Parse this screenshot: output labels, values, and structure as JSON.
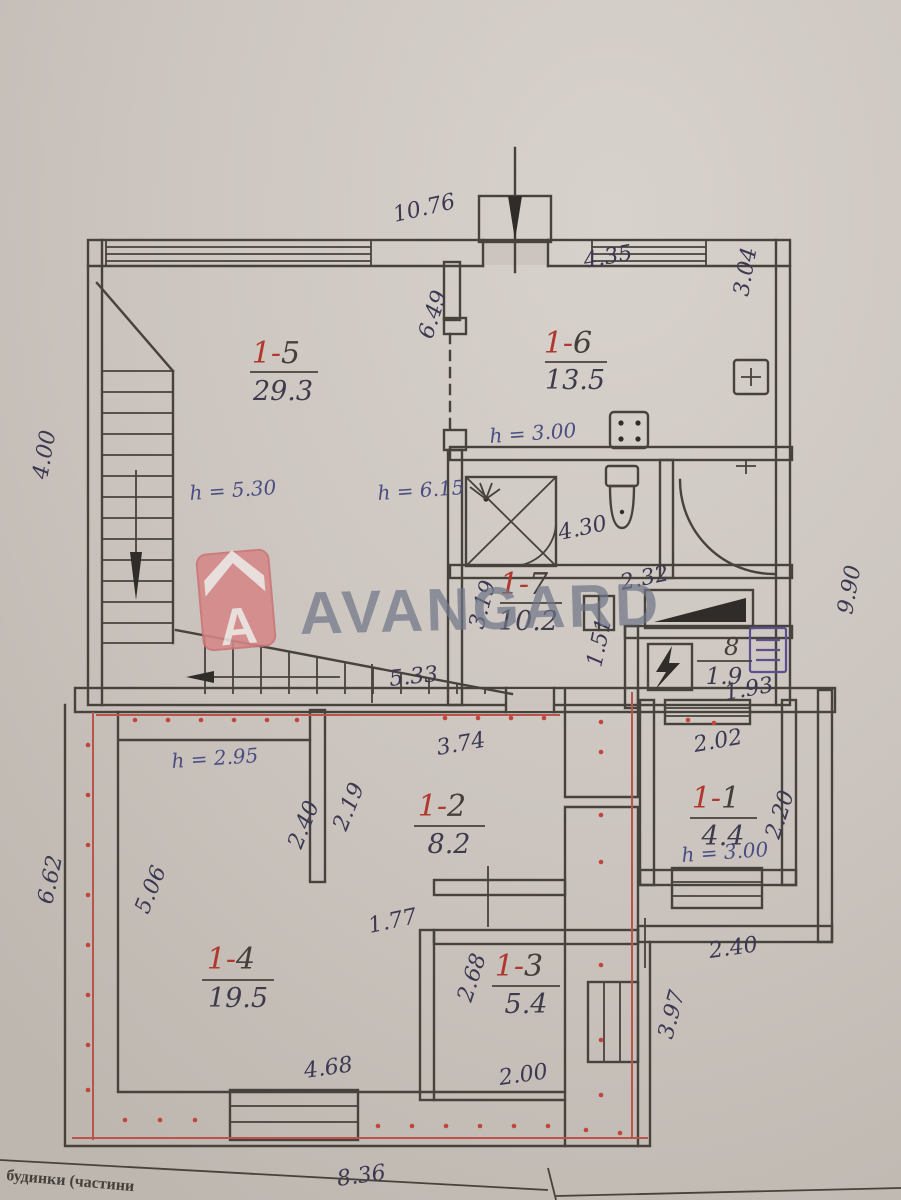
{
  "document": {
    "type": "floor-plan-scan",
    "footer": {
      "line1": "будинки (частини"
    }
  },
  "watermark": {
    "brand": "AVANGARD",
    "logo_letter": "A"
  },
  "rooms": [
    {
      "id": "1-5",
      "prefix": "1-",
      "suffix": "5",
      "area": "29.3"
    },
    {
      "id": "1-6",
      "prefix": "1-",
      "suffix": "6",
      "area": "13.5"
    },
    {
      "id": "1-7",
      "prefix": "1-",
      "suffix": "7",
      "area": "10.2"
    },
    {
      "id": "8",
      "prefix": "",
      "suffix": "8",
      "area": "1.9"
    },
    {
      "id": "1-1",
      "prefix": "1-",
      "suffix": "1",
      "area": "4.4"
    },
    {
      "id": "1-2",
      "prefix": "1-",
      "suffix": "2",
      "area": "8.2"
    },
    {
      "id": "1-3",
      "prefix": "1-",
      "suffix": "3",
      "area": "5.4"
    },
    {
      "id": "1-4",
      "prefix": "1-",
      "suffix": "4",
      "area": "19.5"
    }
  ],
  "dims": [
    {
      "text": "10.76"
    },
    {
      "text": "4.35"
    },
    {
      "text": "3.04"
    },
    {
      "text": "6.49"
    },
    {
      "text": "4.00"
    },
    {
      "text": "4.30"
    },
    {
      "text": "2.32"
    },
    {
      "text": "3.19"
    },
    {
      "text": "1.51"
    },
    {
      "text": "1.93"
    },
    {
      "text": "9.90"
    },
    {
      "text": "5.33"
    },
    {
      "text": "3.74"
    },
    {
      "text": "2.02"
    },
    {
      "text": "2.40"
    },
    {
      "text": "2.19"
    },
    {
      "text": "2.20"
    },
    {
      "text": "5.06"
    },
    {
      "text": "6.62"
    },
    {
      "text": "1.77"
    },
    {
      "text": "2.40"
    },
    {
      "text": "2.68"
    },
    {
      "text": "3.97"
    },
    {
      "text": "2.00"
    },
    {
      "text": "4.68"
    },
    {
      "text": "8.36"
    }
  ],
  "heights": [
    {
      "label": "h = 5.30"
    },
    {
      "label": "h = 6.15"
    },
    {
      "label": "h = 3.00"
    },
    {
      "label": "h = 2.95"
    },
    {
      "label": "h = 3.00"
    }
  ],
  "icons": {
    "entrance_arrow": "down-arrow",
    "stairs_arrow": "down-arrow",
    "shower": "shower-cabin",
    "toilet": "toilet",
    "stove": "gas-stove",
    "sink": "sink",
    "electric_panel": "lightning-bolt",
    "electric_meter": "meter",
    "basement_hatch": "black-wedge"
  },
  "colors": {
    "paper": "#ccc5bf",
    "wall_ink": "#47423c",
    "dim_ink": "#3b3852",
    "height_ink": "#4a4d82",
    "room_red": "#b0392f",
    "outline_red": "#c2453c",
    "watermark_red": "#d68787",
    "watermark_gray": "#6e7687"
  }
}
